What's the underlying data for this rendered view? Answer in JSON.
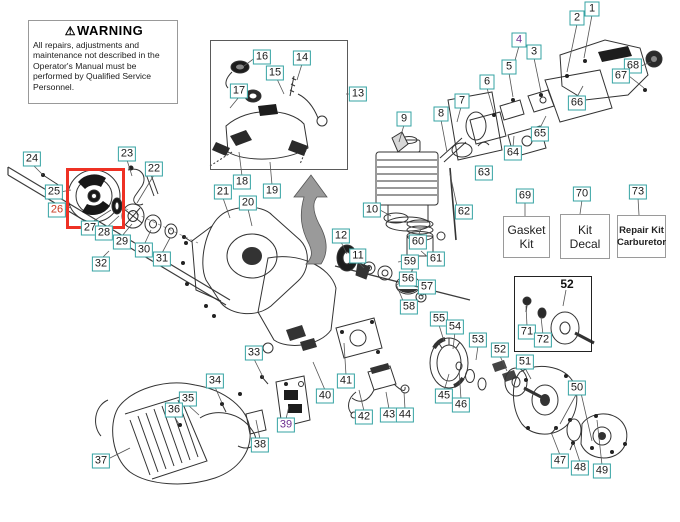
{
  "warning": {
    "icon": "⚠",
    "title": "WARNING",
    "body": "All repairs, adjustments and maintenance not described in the Operator's Manual must be performed by Qualified Service Personnel."
  },
  "kits": [
    {
      "num": "69",
      "line1": "Gasket",
      "line2": "Kit"
    },
    {
      "num": "70",
      "line1": "Kit",
      "line2": "Decal"
    },
    {
      "num": "73",
      "line1": "Repair Kit",
      "line2": "Carburetor"
    }
  ],
  "subdiagram": {
    "part_number": "52"
  },
  "colors": {
    "label_border": "#34a3a3",
    "highlight_red": "#ee3124",
    "selected_number": "#c8391f",
    "visited_number": "#6b2d90",
    "arrow_gray": "#9a9a9a"
  },
  "labels": [
    {
      "n": "1",
      "x": 592,
      "y": 9
    },
    {
      "n": "2",
      "x": 577,
      "y": 18
    },
    {
      "n": "3",
      "x": 534,
      "y": 52
    },
    {
      "n": "4",
      "x": 519,
      "y": 40,
      "c": "purple"
    },
    {
      "n": "5",
      "x": 509,
      "y": 67
    },
    {
      "n": "6",
      "x": 487,
      "y": 82
    },
    {
      "n": "68",
      "x": 633,
      "y": 66
    },
    {
      "n": "67",
      "x": 621,
      "y": 76
    },
    {
      "n": "66",
      "x": 577,
      "y": 103
    },
    {
      "n": "65",
      "x": 540,
      "y": 134
    },
    {
      "n": "64",
      "x": 513,
      "y": 153
    },
    {
      "n": "7",
      "x": 462,
      "y": 101
    },
    {
      "n": "8",
      "x": 441,
      "y": 114
    },
    {
      "n": "9",
      "x": 404,
      "y": 119
    },
    {
      "n": "13",
      "x": 358,
      "y": 94
    },
    {
      "n": "63",
      "x": 484,
      "y": 173
    },
    {
      "n": "10",
      "x": 372,
      "y": 210
    },
    {
      "n": "62",
      "x": 464,
      "y": 212
    },
    {
      "n": "12",
      "x": 341,
      "y": 236
    },
    {
      "n": "11",
      "x": 358,
      "y": 256
    },
    {
      "n": "60",
      "x": 418,
      "y": 242
    },
    {
      "n": "59",
      "x": 410,
      "y": 262
    },
    {
      "n": "61",
      "x": 436,
      "y": 259
    },
    {
      "n": "56",
      "x": 408,
      "y": 279
    },
    {
      "n": "57",
      "x": 427,
      "y": 287
    },
    {
      "n": "58",
      "x": 409,
      "y": 307
    },
    {
      "n": "55",
      "x": 439,
      "y": 319
    },
    {
      "n": "54",
      "x": 455,
      "y": 327
    },
    {
      "n": "53",
      "x": 478,
      "y": 340
    },
    {
      "n": "52",
      "x": 500,
      "y": 350
    },
    {
      "n": "51",
      "x": 525,
      "y": 362
    },
    {
      "n": "50",
      "x": 577,
      "y": 388
    },
    {
      "n": "45",
      "x": 444,
      "y": 396
    },
    {
      "n": "46",
      "x": 461,
      "y": 405
    },
    {
      "n": "47",
      "x": 560,
      "y": 461
    },
    {
      "n": "48",
      "x": 580,
      "y": 468
    },
    {
      "n": "49",
      "x": 602,
      "y": 471
    },
    {
      "n": "40",
      "x": 325,
      "y": 396
    },
    {
      "n": "41",
      "x": 346,
      "y": 381
    },
    {
      "n": "42",
      "x": 364,
      "y": 417
    },
    {
      "n": "43",
      "x": 389,
      "y": 415
    },
    {
      "n": "44",
      "x": 405,
      "y": 415
    },
    {
      "n": "33",
      "x": 254,
      "y": 353
    },
    {
      "n": "34",
      "x": 215,
      "y": 381
    },
    {
      "n": "35",
      "x": 188,
      "y": 399
    },
    {
      "n": "36",
      "x": 174,
      "y": 410
    },
    {
      "n": "37",
      "x": 101,
      "y": 461
    },
    {
      "n": "38",
      "x": 260,
      "y": 445
    },
    {
      "n": "39",
      "x": 286,
      "y": 425,
      "c": "purple"
    },
    {
      "n": "21",
      "x": 223,
      "y": 192
    },
    {
      "n": "20",
      "x": 248,
      "y": 203
    },
    {
      "n": "18",
      "x": 242,
      "y": 182
    },
    {
      "n": "19",
      "x": 272,
      "y": 191
    },
    {
      "n": "16",
      "x": 262,
      "y": 57
    },
    {
      "n": "14",
      "x": 302,
      "y": 58
    },
    {
      "n": "15",
      "x": 275,
      "y": 73
    },
    {
      "n": "17",
      "x": 239,
      "y": 91
    },
    {
      "n": "22",
      "x": 154,
      "y": 169
    },
    {
      "n": "23",
      "x": 127,
      "y": 154
    },
    {
      "n": "24",
      "x": 32,
      "y": 159
    },
    {
      "n": "25",
      "x": 54,
      "y": 192
    },
    {
      "n": "26",
      "x": 57,
      "y": 210,
      "c": "red"
    },
    {
      "n": "27",
      "x": 90,
      "y": 228
    },
    {
      "n": "28",
      "x": 104,
      "y": 233
    },
    {
      "n": "29",
      "x": 122,
      "y": 242
    },
    {
      "n": "30",
      "x": 144,
      "y": 250
    },
    {
      "n": "31",
      "x": 162,
      "y": 259
    },
    {
      "n": "32",
      "x": 101,
      "y": 264
    },
    {
      "n": "71",
      "x": 527,
      "y": 332
    },
    {
      "n": "72",
      "x": 543,
      "y": 340
    },
    {
      "n": "69",
      "x": 525,
      "y": 196
    },
    {
      "n": "70",
      "x": 582,
      "y": 194
    },
    {
      "n": "73",
      "x": 638,
      "y": 192
    }
  ]
}
